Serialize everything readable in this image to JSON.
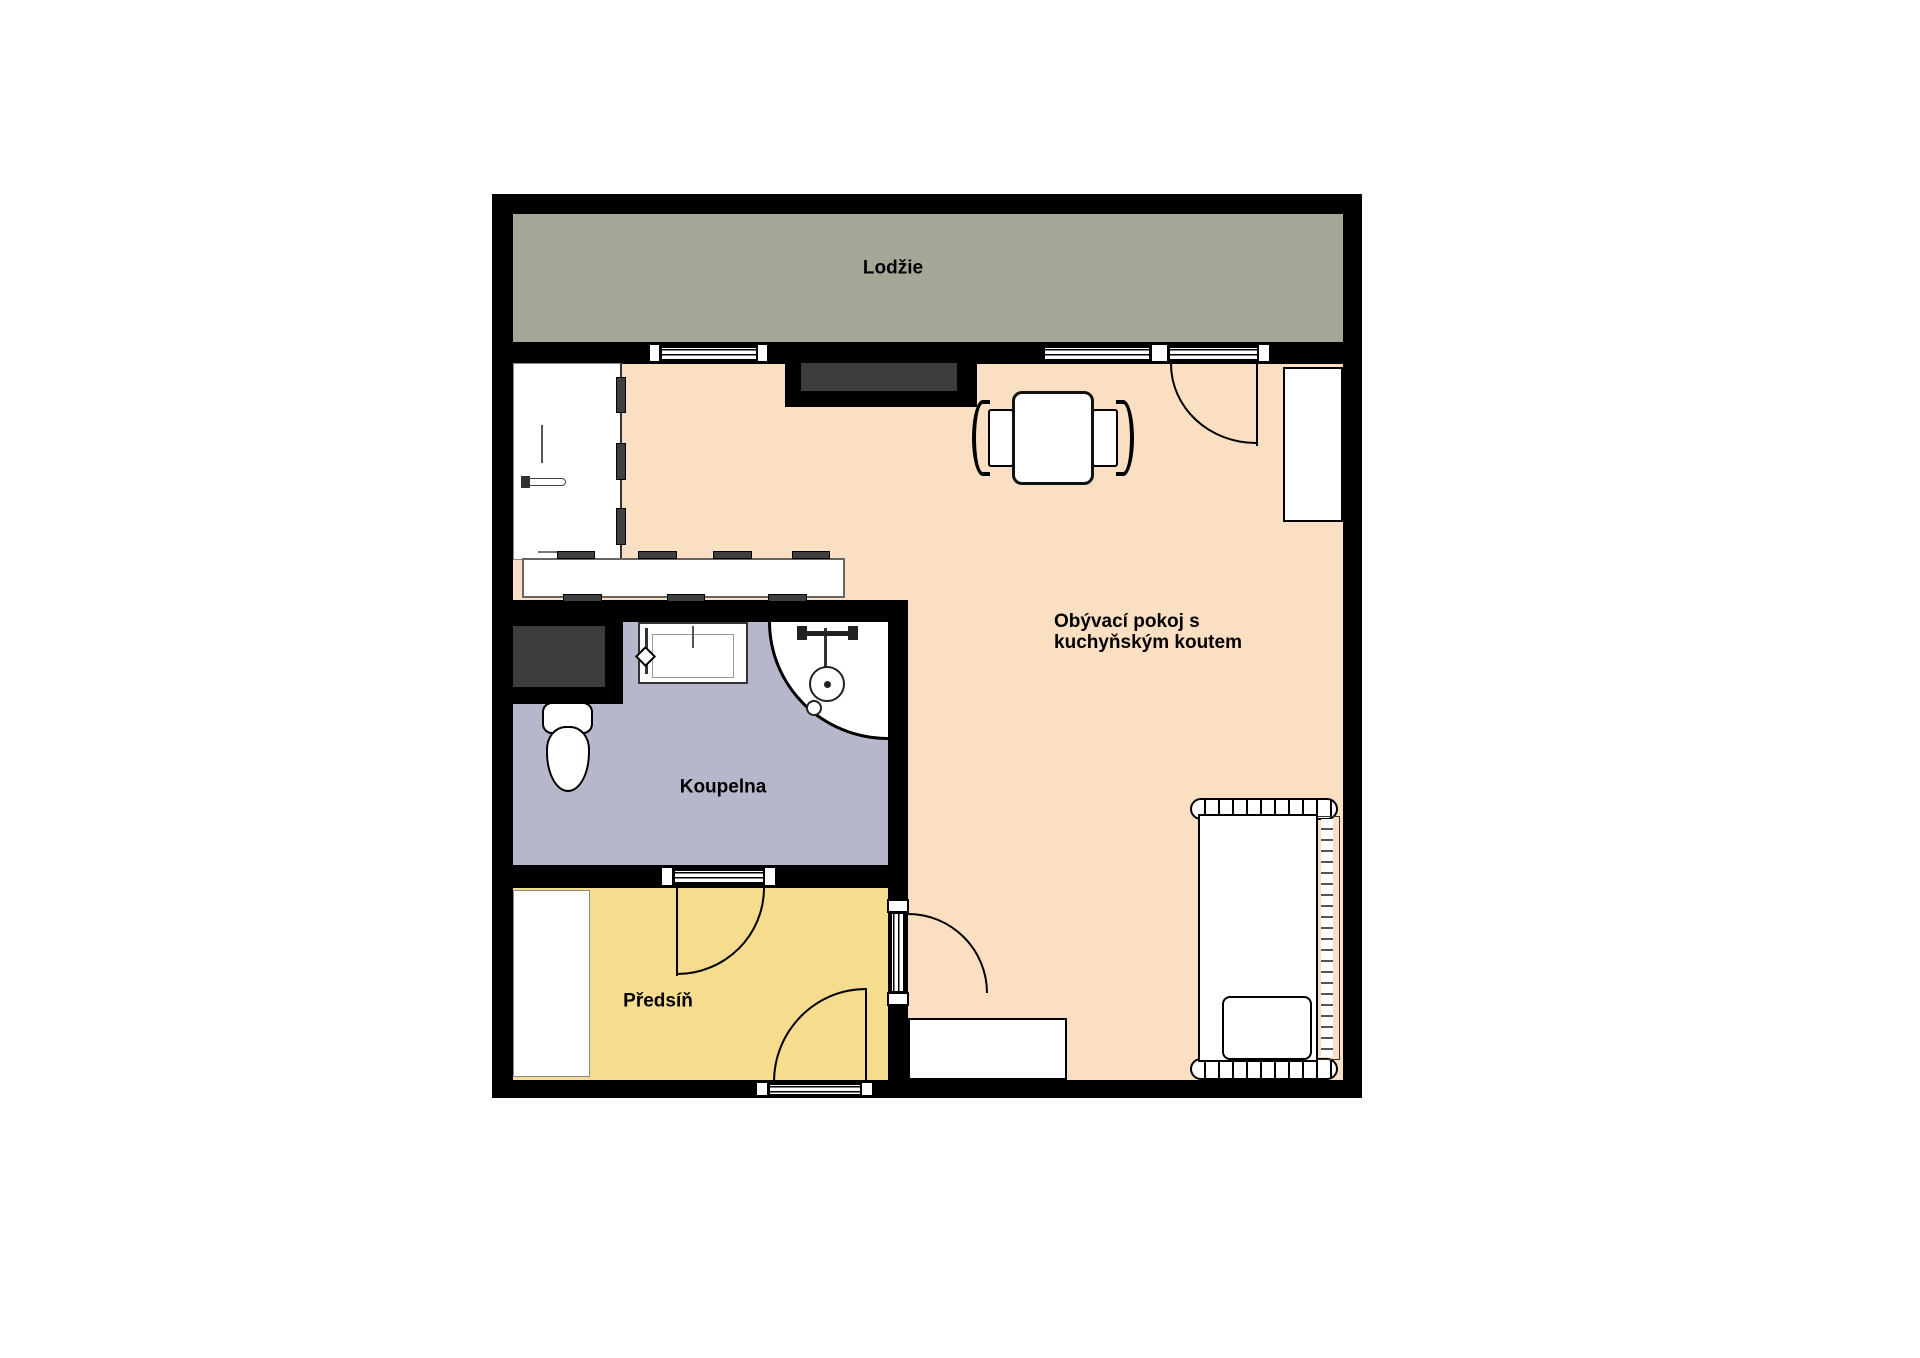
{
  "title": "Floor plan",
  "rooms": {
    "loggia": {
      "label": "Lodžie"
    },
    "living": {
      "label_line1": "Obývací pokoj s",
      "label_line2": "kuchyňským koutem"
    },
    "bathroom": {
      "label": "Koupelna"
    },
    "hallway": {
      "label": "Předsíň"
    }
  },
  "colors": {
    "wall": "#000000",
    "loggia": "#a6a697",
    "living": "#fbdfc2",
    "bathroom": "#b6b7cb",
    "hallway": "#f6dc8e",
    "shaft": "#3d3d3d",
    "background": "#ffffff"
  }
}
